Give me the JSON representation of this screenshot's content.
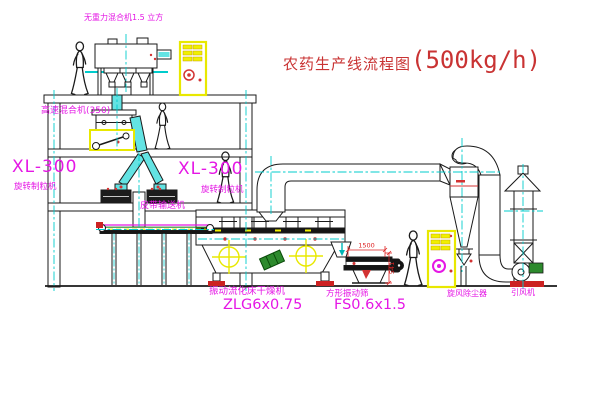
{
  "title": {
    "text": "农药生产线流程图",
    "capacity": "(500kg/h)"
  },
  "equipment_labels": {
    "gravity_free_mixer": "无重力混合机1.5 立方",
    "high_speed_mixer": "高速混合机(350)",
    "granulator_left": {
      "model": "XL-300",
      "name": "旋转制粒机"
    },
    "granulator_mid": {
      "model": "XL-300",
      "name": "旋转制粒机"
    },
    "belt_conveyor": "皮带输送机",
    "fluid_bed_dryer": {
      "name": "振动流化床干燥机",
      "model": "ZLG6x0.75"
    },
    "square_sifter": {
      "name": "方形振动筛",
      "model": "FS0.6x1.5"
    },
    "cyclone_dust_collector": "旋风除尘器",
    "induced_draft_fan": "引风机"
  },
  "dimensions": {
    "sifter_length": "1500",
    "sifter_height": "541"
  },
  "colors": {
    "label_magenta": "#e517e5",
    "title_red": "#c93333",
    "centerline_cyan": "#00cccc",
    "duct_cyan": "#63e3e3",
    "cabinet_yellow": "#f0f000",
    "dimension_red": "#dd2222",
    "motor_green": "#2d8a2d",
    "base_red": "#cc2222"
  }
}
